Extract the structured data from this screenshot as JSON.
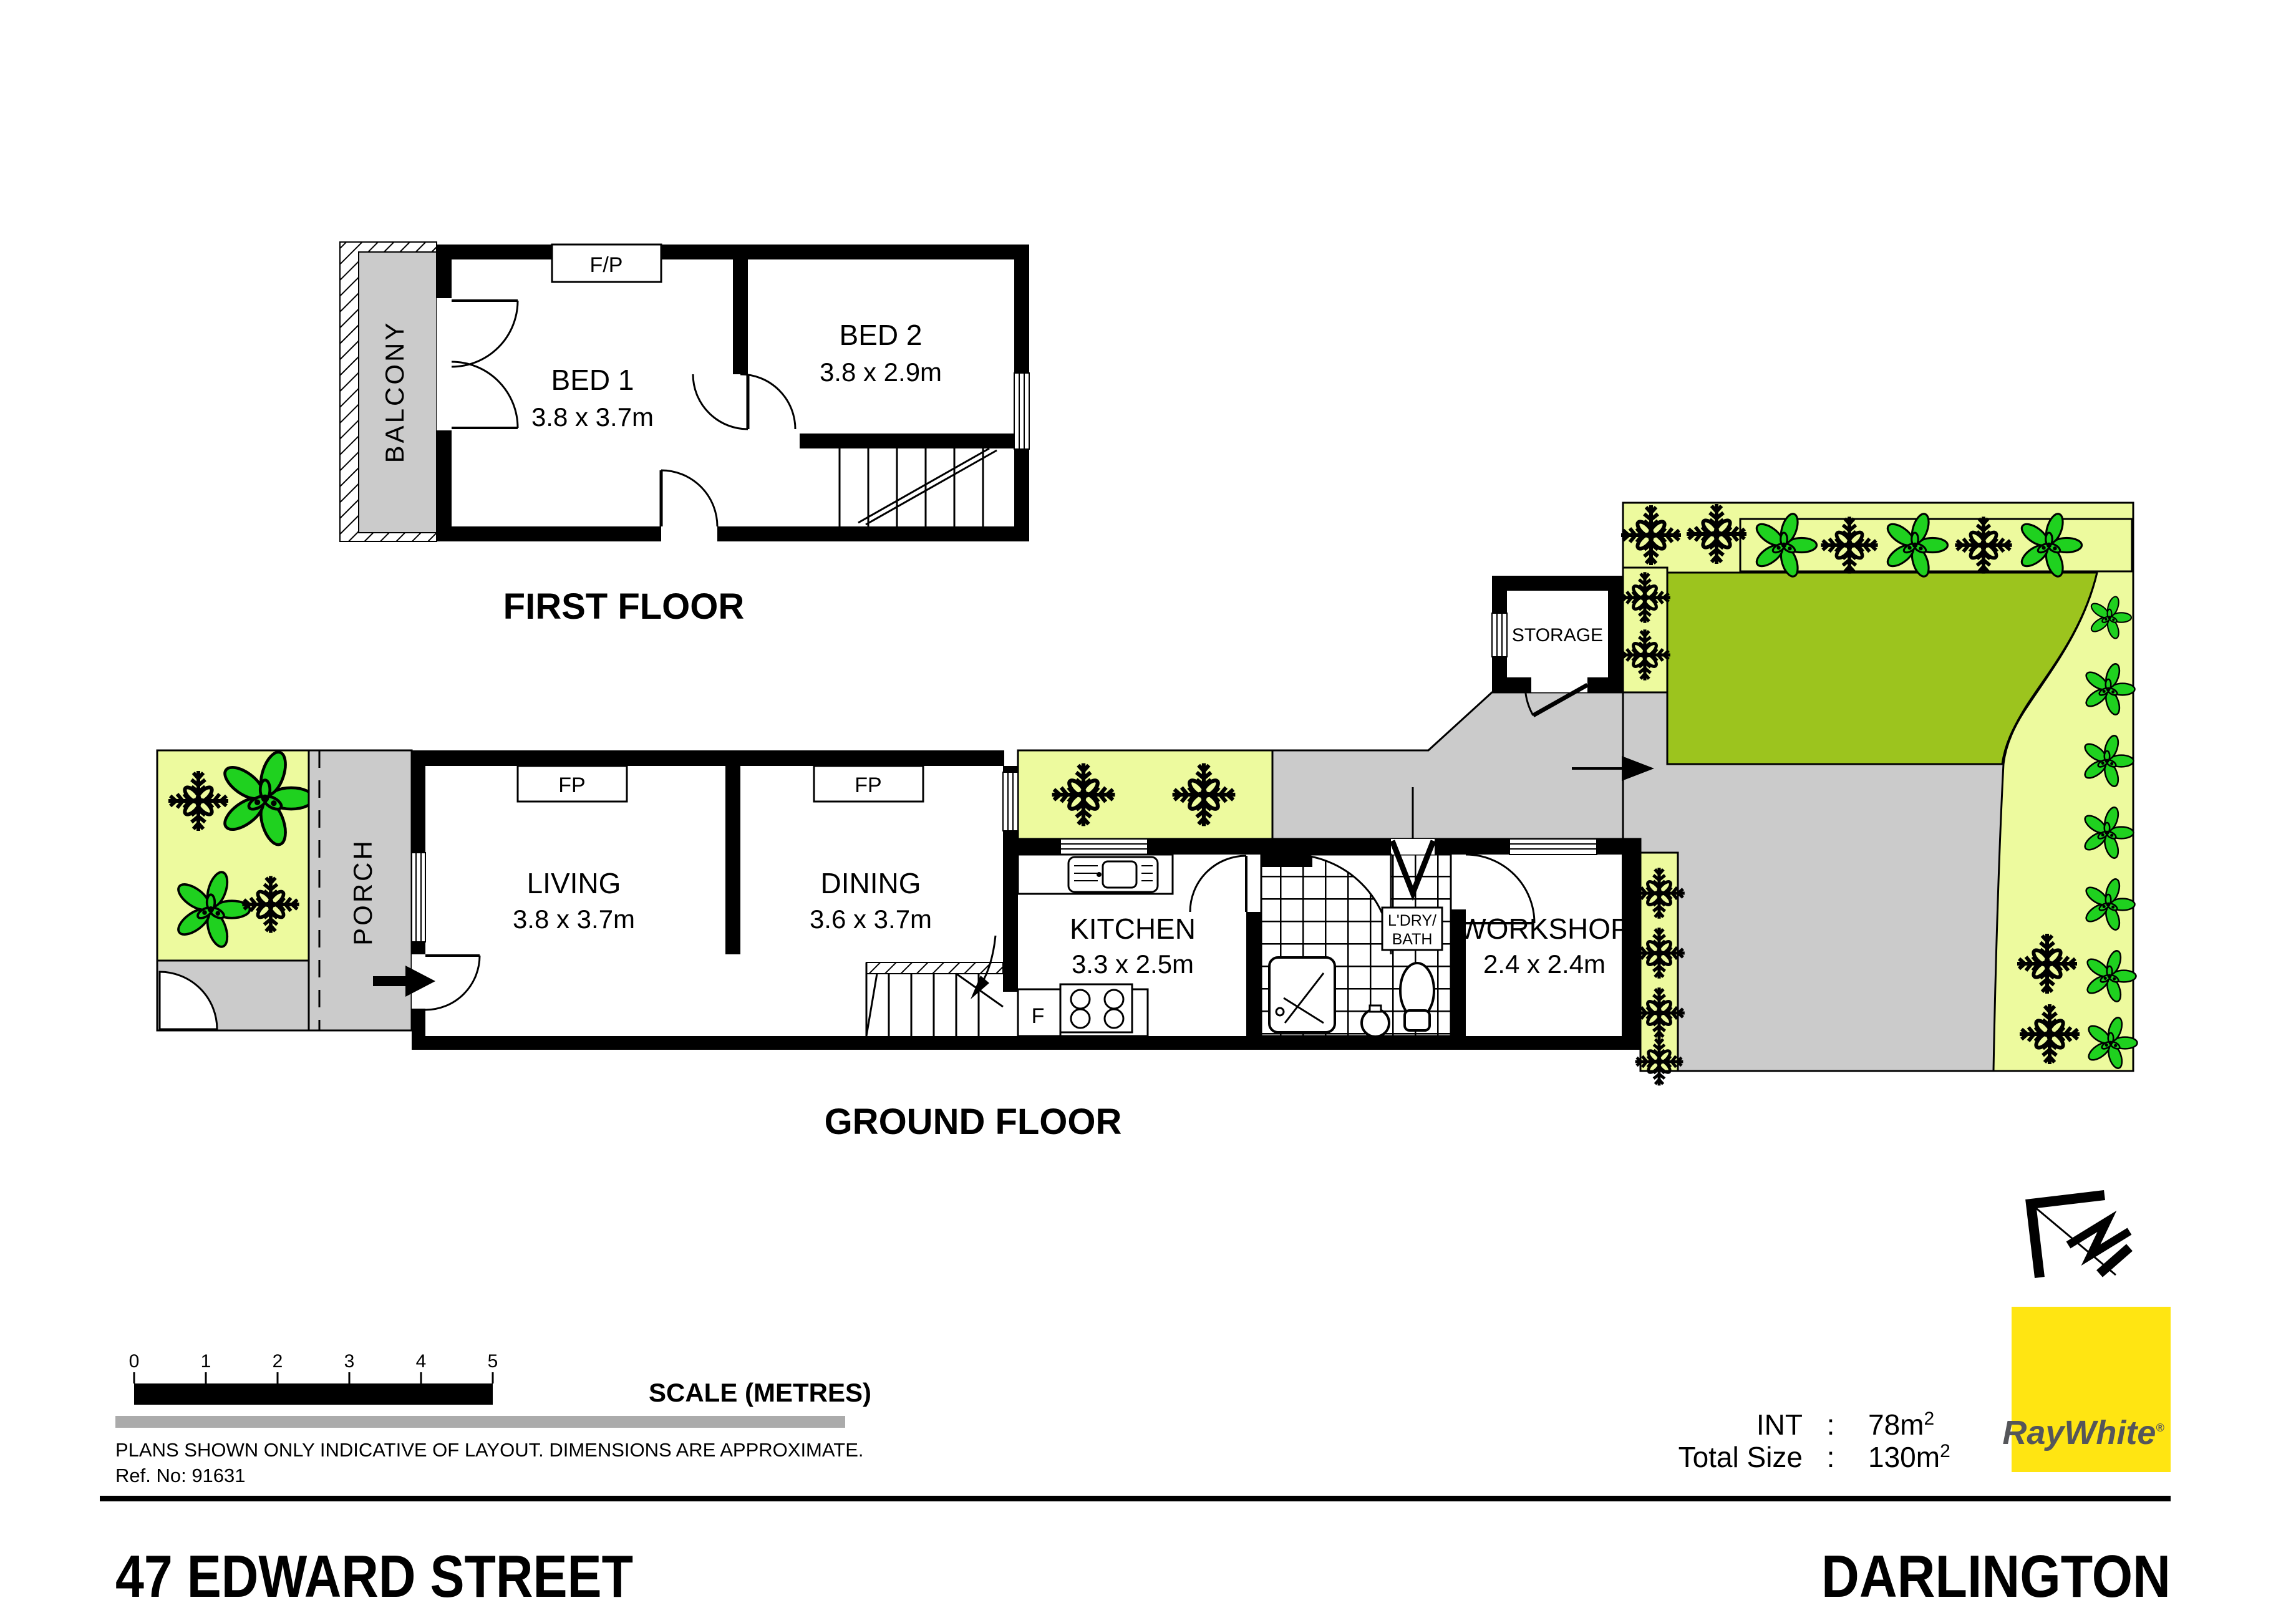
{
  "first_floor": {
    "title": "FIRST FLOOR",
    "balcony": "BALCONY",
    "fireplace": "F/P",
    "bed1": {
      "name": "BED 1",
      "dims": "3.8 x 3.7m"
    },
    "bed2": {
      "name": "BED 2",
      "dims": "3.8 x 2.9m"
    }
  },
  "ground_floor": {
    "title": "GROUND FLOOR",
    "porch": "PORCH",
    "living": {
      "name": "LIVING",
      "dims": "3.8 x 3.7m",
      "fireplace": "FP"
    },
    "dining": {
      "name": "DINING",
      "dims": "3.6 x 3.7m",
      "fireplace": "FP"
    },
    "kitchen": {
      "name": "KITCHEN",
      "dims": "3.3 x 2.5m",
      "fridge": "F"
    },
    "laundry_bath": {
      "line1": "L'DRY/",
      "line2": "BATH"
    },
    "workshop": {
      "name": "WORKSHOP",
      "dims": "2.4 x 2.4m"
    },
    "storage": "STORAGE"
  },
  "scale_bar": {
    "ticks": [
      "0",
      "1",
      "2",
      "3",
      "4",
      "5"
    ],
    "label": "SCALE (METRES)"
  },
  "notes": {
    "disclaimer": "PLANS SHOWN ONLY INDICATIVE OF LAYOUT.  DIMENSIONS ARE APPROXIMATE.",
    "ref": "Ref. No: 91631"
  },
  "summary": {
    "int": {
      "label": "INT",
      "colon": ":",
      "value": "78m",
      "sup": "2"
    },
    "total": {
      "label": "Total Size",
      "colon": ":",
      "value": "130m",
      "sup": "2"
    }
  },
  "brand": {
    "name": "RayWhite",
    "mark": "®"
  },
  "footer": {
    "address": "47 EDWARD STREET",
    "suburb": "DARLINGTON"
  },
  "colors": {
    "garden": "#edfa9e",
    "lawn": "#9cc41e",
    "flower": "#1fd11f",
    "path_gray": "#cbcbcb",
    "brand_yellow": "#ffe512",
    "brand_gray": "#55565a"
  }
}
